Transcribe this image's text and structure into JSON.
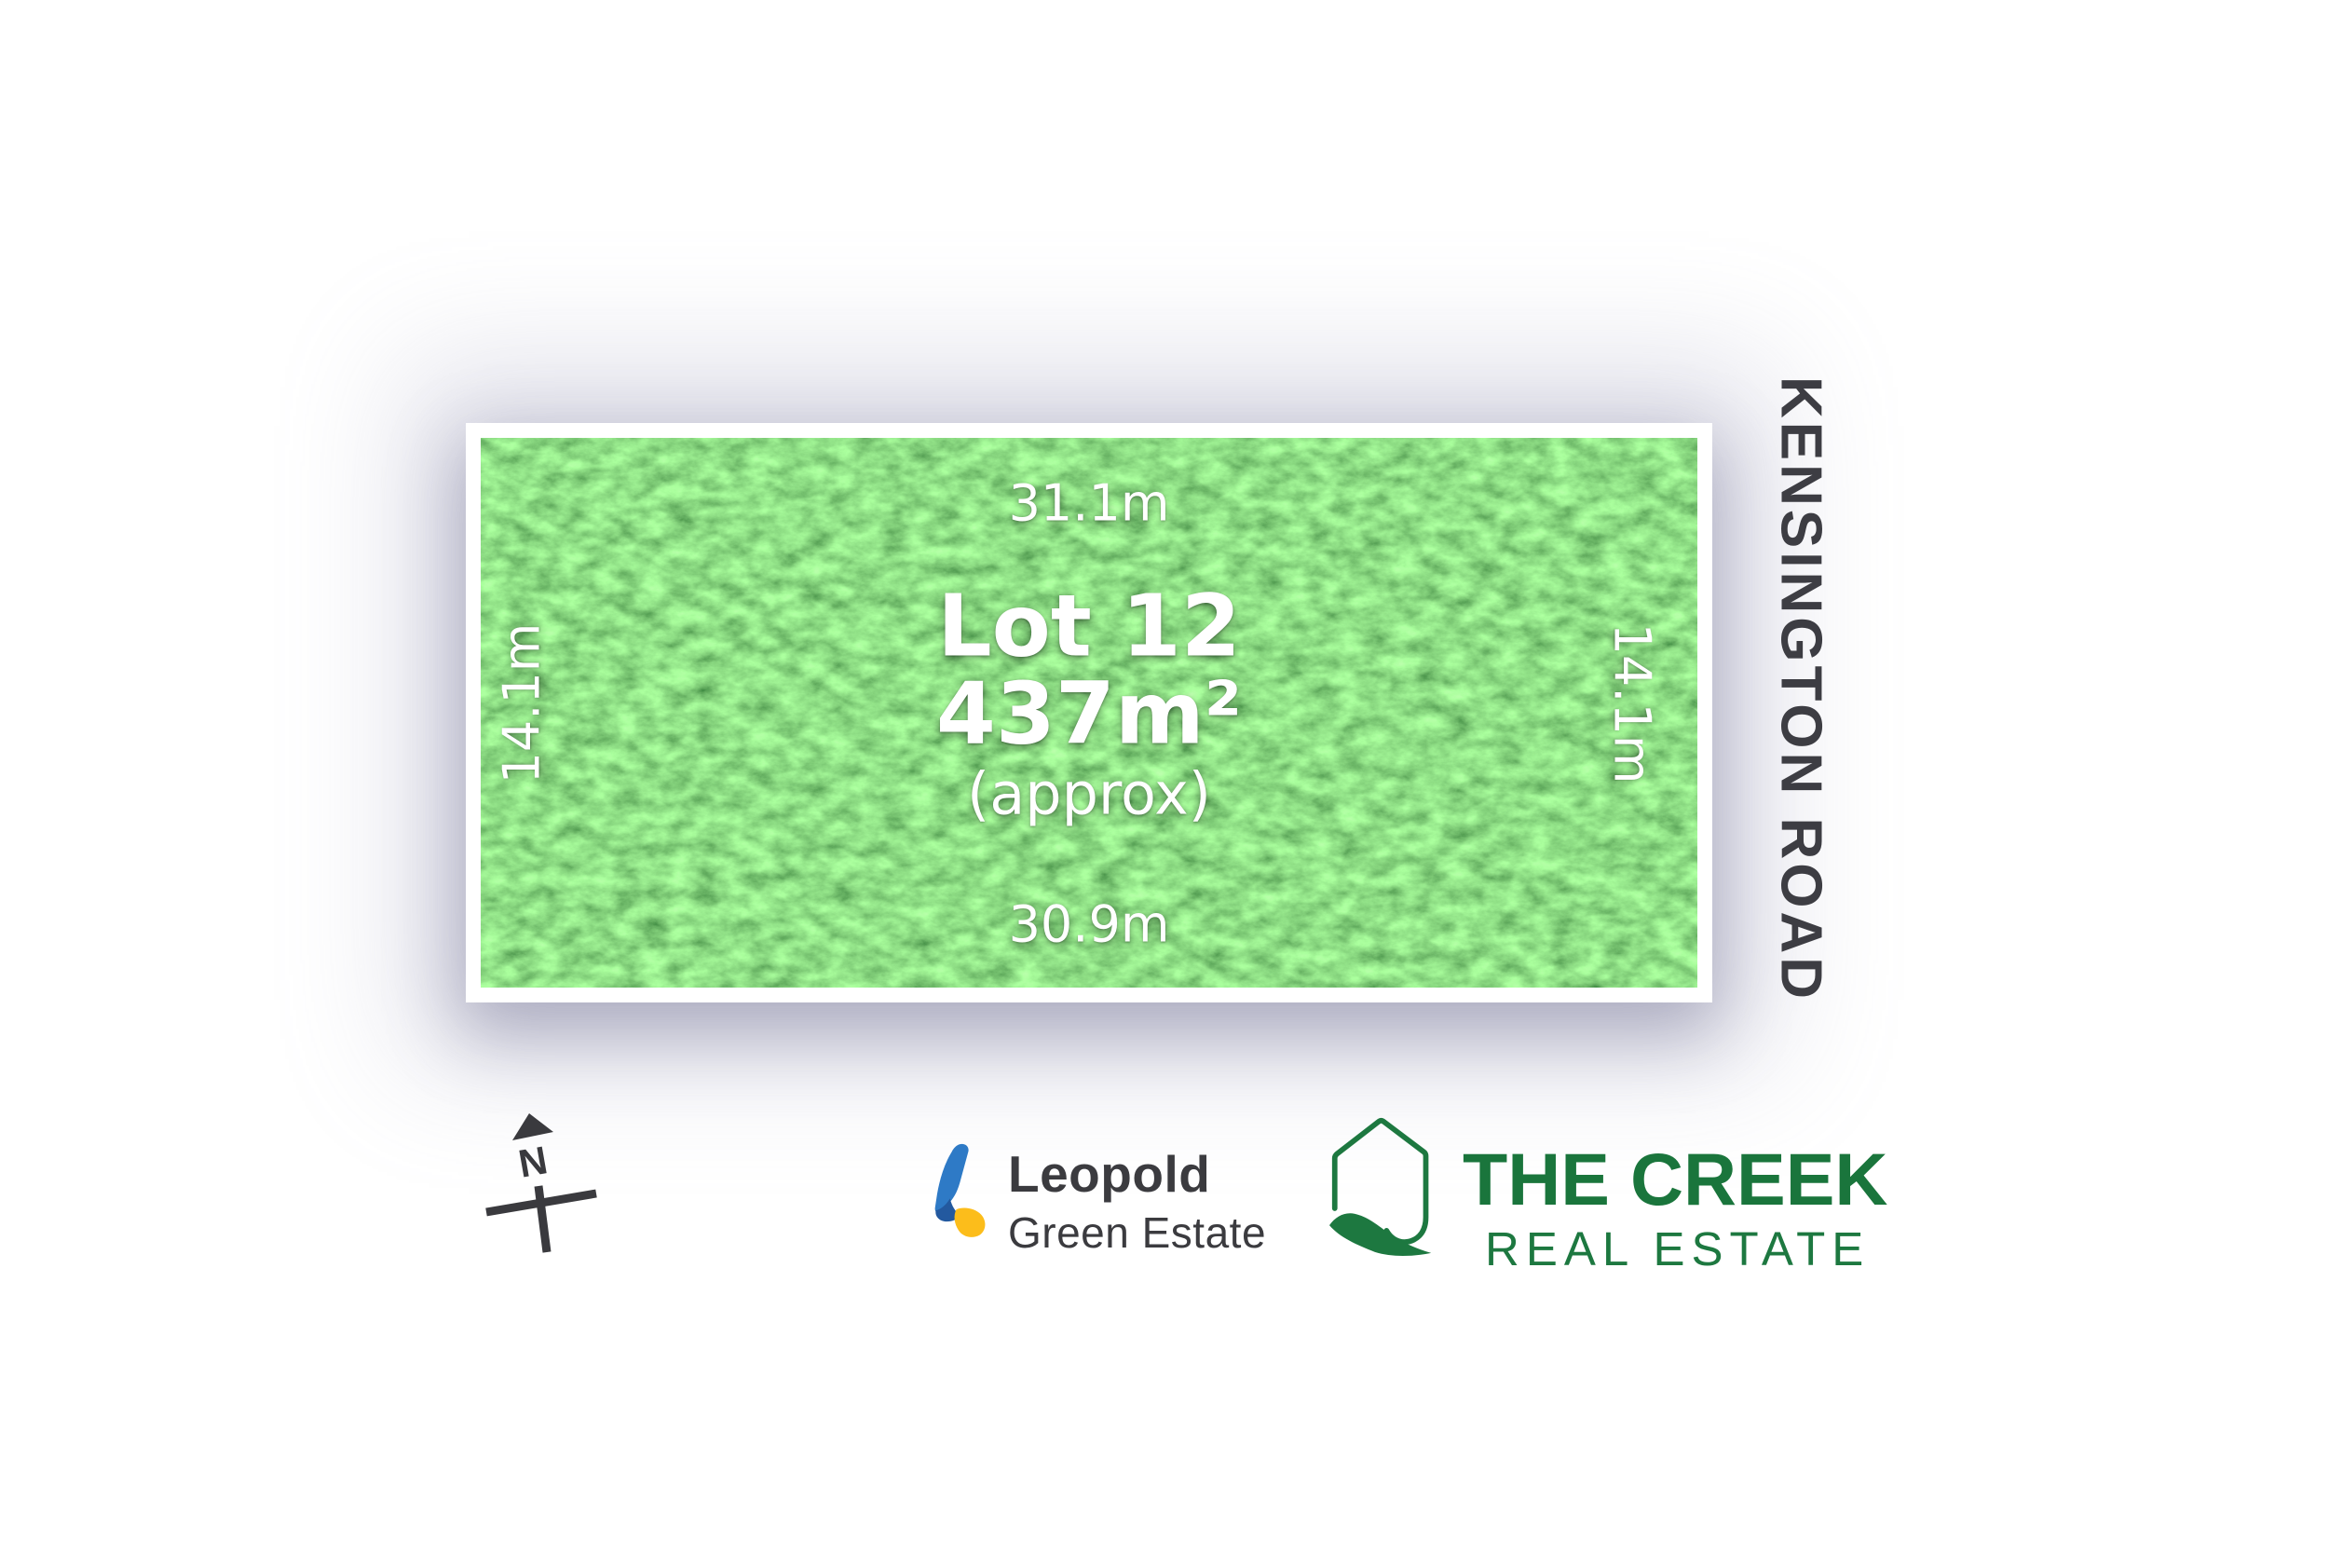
{
  "lot": {
    "label": "Lot 12",
    "area": "437m²",
    "area_qualifier": "(approx)",
    "boundaries": {
      "top": "31.1m",
      "bottom": "30.9m",
      "left": "14.1m",
      "right": "14.1m"
    }
  },
  "road": {
    "name": "KENSINGTON ROAD"
  },
  "compass": {
    "north_label": "N"
  },
  "branding": {
    "estate": {
      "name": "Leopold",
      "subtitle": "Green Estate"
    },
    "agency": {
      "name": "THE CREEK",
      "subtitle": "REAL ESTATE"
    }
  },
  "colors": {
    "grass_green": "#47be3d",
    "creek_green": "#1d7840",
    "leopold_blue": "#2e7ac6",
    "leopold_dark_blue": "#23599f",
    "leopold_yellow": "#fcbd1b",
    "dark_text": "#3b3b3f",
    "road_text": "#3d3d43",
    "shadow_tint": "#9898b8"
  }
}
